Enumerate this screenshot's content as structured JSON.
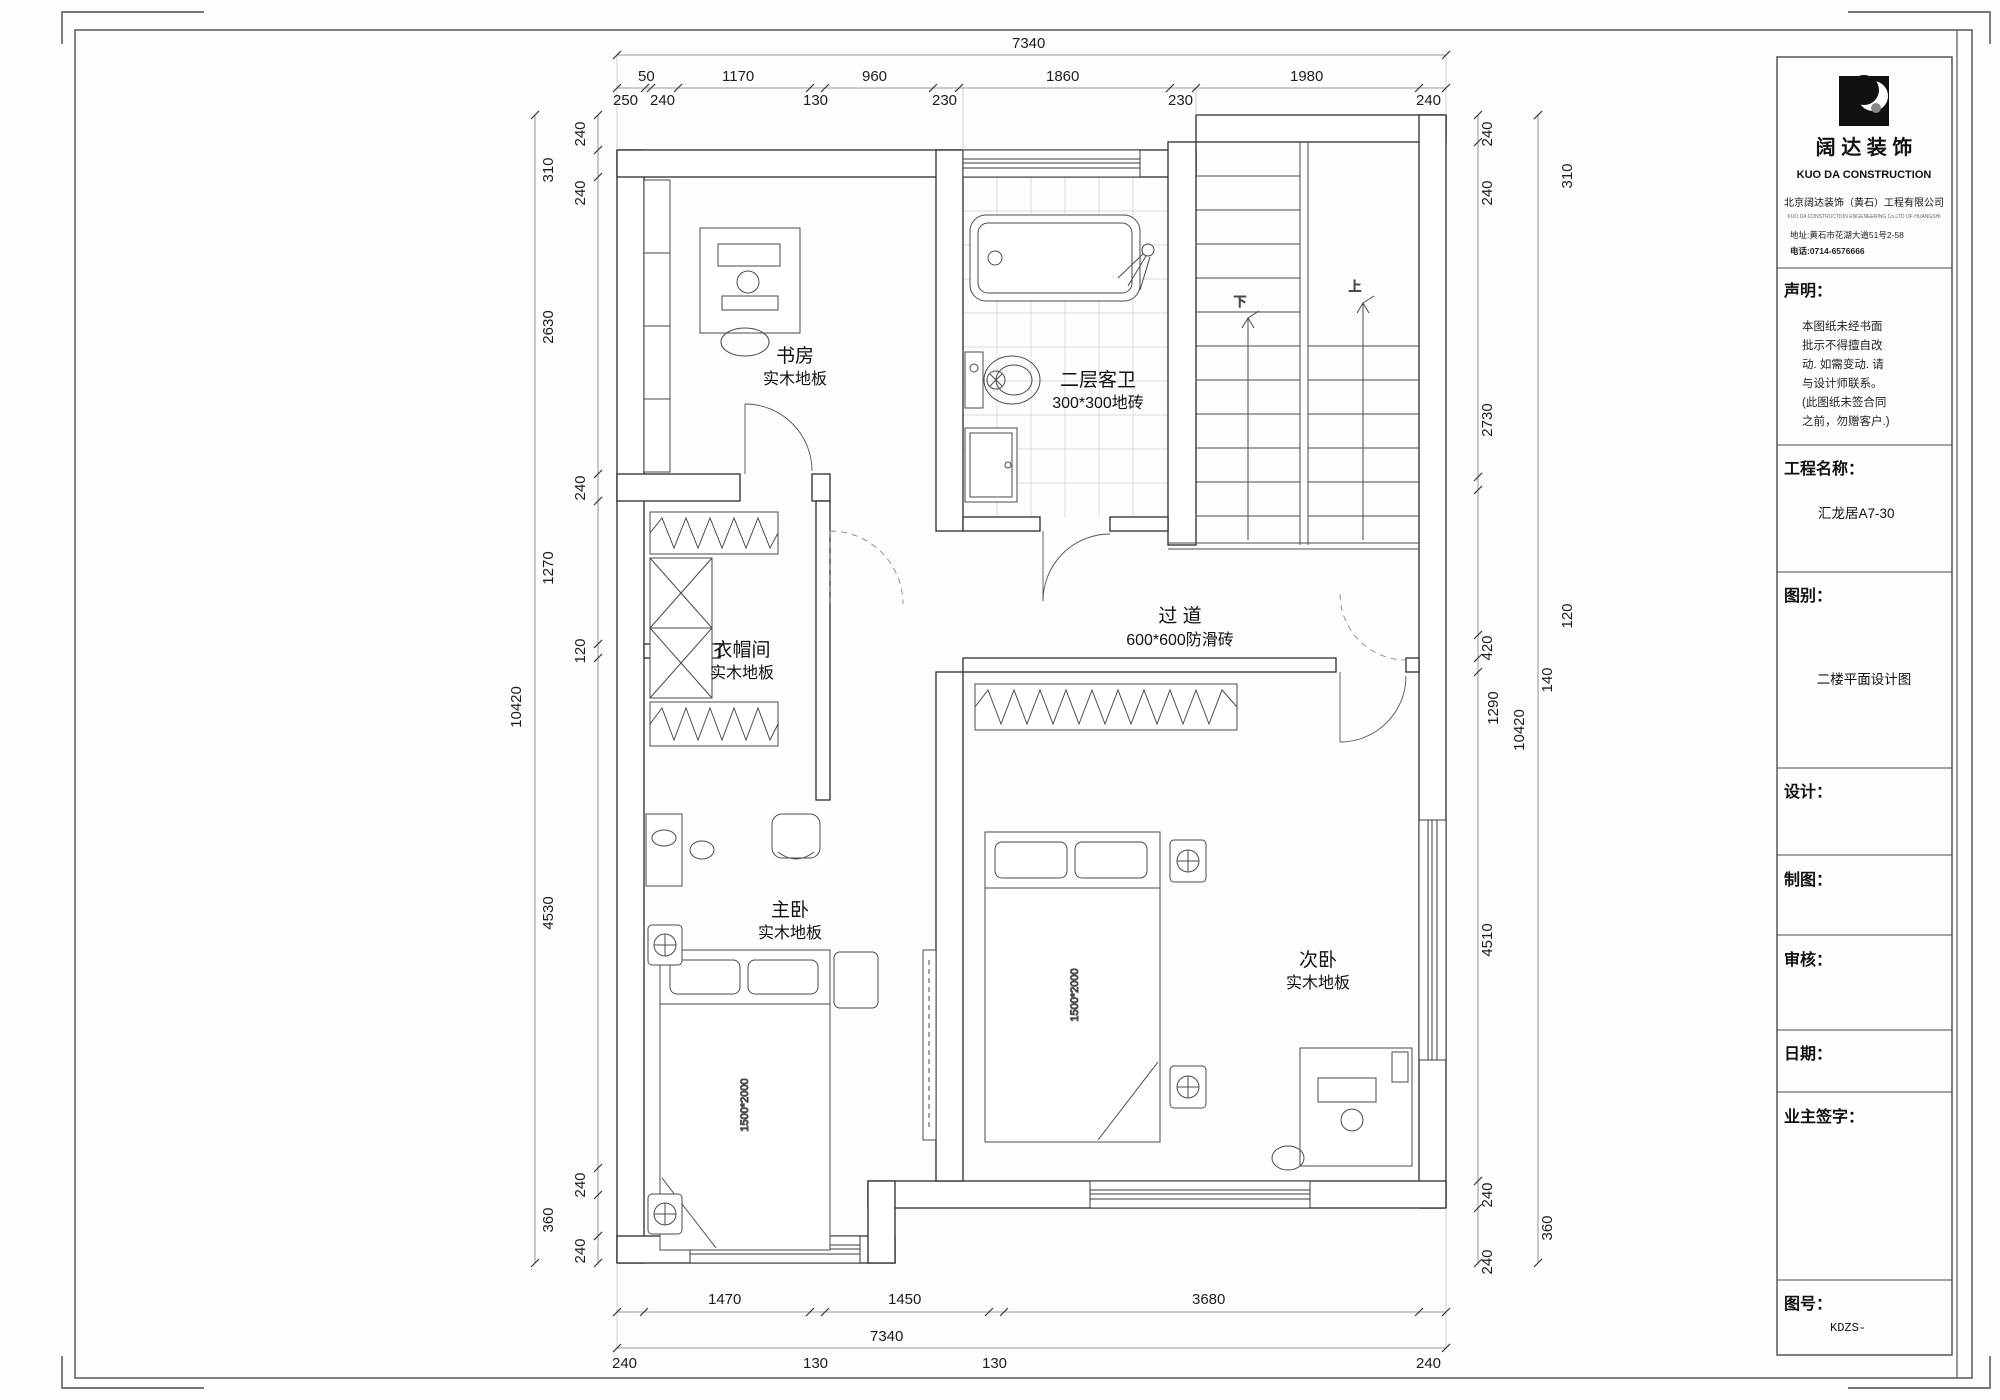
{
  "title_block": {
    "logo_cn": "阔 达 装 饰",
    "logo_en": "KUO DA CONSTRUCTION",
    "company": "北京阔达装饰（黄石）工程有限公司",
    "company_en": "KUO DA CONSTRUCTION ENGENEERING Co.LTD OF HUANGSHI",
    "address": "地址:黄石市花湖大道51号2-58",
    "phone": "电话:0714-6576666",
    "statement_label": "声明：",
    "statement_lines": [
      "本图纸未经书面",
      "批示不得擅自改",
      "动. 如需变动. 请",
      "与设计师联系。",
      "(此图纸未签合同",
      "之前，勿赠客户.)"
    ],
    "project_label": "工程名称：",
    "project_value": "汇龙居A7-30",
    "drawing_type_label": "图别：",
    "drawing_type_value": "二楼平面设计图",
    "design_label": "设计：",
    "draft_label": "制图：",
    "review_label": "审核：",
    "date_label": "日期：",
    "owner_sign_label": "业主签字：",
    "drawing_no_label": "图号：",
    "drawing_no_value": "KDZS-"
  },
  "plan": {
    "rooms": {
      "study": {
        "name": "书房",
        "floor": "实木地板"
      },
      "bath": {
        "name": "二层客卫",
        "floor": "300*300地砖"
      },
      "cloak": {
        "name": "衣帽间",
        "floor": "实木地板"
      },
      "corridor": {
        "name": "过    道",
        "floor": "600*600防滑砖"
      },
      "master": {
        "name": "主卧",
        "floor": "实木地板"
      },
      "second": {
        "name": "次卧",
        "floor": "实木地板"
      }
    },
    "stairs": {
      "up": "上",
      "down": "下"
    },
    "beds": {
      "label": "1500*2000"
    }
  },
  "dimens": {
    "top": {
      "overall": "7340",
      "row1": [
        "50",
        "1170",
        "960",
        "1860",
        "1980"
      ],
      "row2": [
        "250",
        "240",
        "130",
        "230",
        "230",
        "240"
      ]
    },
    "bottom": {
      "overall": "7340",
      "row1": [
        "1470",
        "1450",
        "3680"
      ],
      "row2": [
        "240",
        "130",
        "130",
        "240"
      ]
    },
    "left": {
      "overall": "10420",
      "labels": [
        "240",
        "310",
        "240",
        "2630",
        "240",
        "1270",
        "120",
        "4530",
        "240",
        "360",
        "240"
      ]
    },
    "right": {
      "overall": "10420",
      "labels": [
        "240",
        "310",
        "240",
        "2730",
        "120",
        "1290",
        "420",
        "140",
        "4510",
        "240",
        "360",
        "240"
      ]
    }
  }
}
